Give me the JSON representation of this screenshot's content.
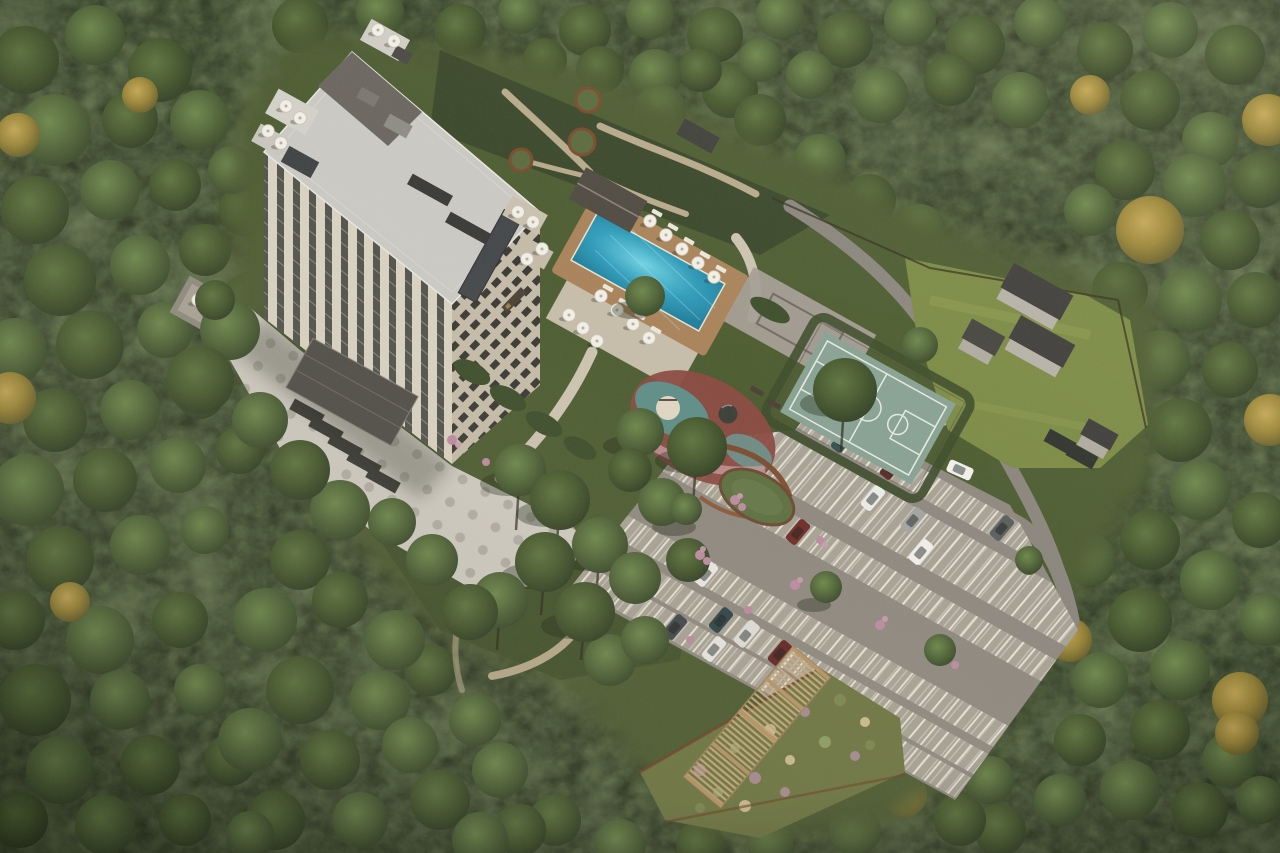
{
  "scene": {
    "type": "aerial-architectural-rendering",
    "subject": "forest resort hotel complex with pool, sports courts and parking",
    "colors": {
      "forest_base": "#2c3722",
      "forest_autumn": "#b99b49",
      "clearing": "#4d5c31",
      "lawn": "#7b8a45",
      "plaza": "#cdc9c0",
      "plaza_dot": "#a8a299",
      "path_tan": "#b7a98b",
      "walkway": "#cbc2b0",
      "road": "#8a857d",
      "pool_water": "#2f9cba",
      "pool_deck": "#a8825a",
      "pool_apron": "#cfc6b4",
      "poolhouse_roof": "#4f4a42",
      "facade_front": "#d8d1c0",
      "facade_side": "#c3baa8",
      "window_glass": "#3a3c38",
      "roof": "#c9c8c4",
      "roof_dark": "#6a6660",
      "entrance_canopy": "#504d48",
      "court": "#87a193",
      "court_line": "#e3e9e2",
      "practice_pavement": "#a39d95",
      "playground_red": "#8a4a42",
      "playground_teal": "#5f8d88",
      "pavilion_roof": "#5d7040",
      "corten": "#7a4a2c",
      "parking_asphalt": "#8e8880",
      "parking_band": "#a7a195",
      "stall_line": "#edeade",
      "pergola_wood": "#c8a97c",
      "flower_garden": "#6e7643",
      "shrub_dark": "#3d4d2b",
      "flower_pink": "#bb8aa0"
    },
    "building": {
      "floors_visible": 12,
      "rooftop_umbrella_count": 12,
      "has_brand_plaque": true
    },
    "pool": {
      "umbrella_count": 12,
      "lounger_count": 9
    },
    "parking": {
      "car_count": 14,
      "cars": [
        {
          "color": "#36504f"
        },
        {
          "color": "#5d2a26"
        },
        {
          "color": "#5b5e5f"
        },
        {
          "color": "#ebebe7"
        },
        {
          "color": "#a3a4a1"
        },
        {
          "color": "#efede8"
        },
        {
          "color": "#6e2d28"
        },
        {
          "color": "#e8e6e1"
        },
        {
          "color": "#dddcd6"
        },
        {
          "color": "#2f4549"
        },
        {
          "color": "#632726"
        },
        {
          "color": "#43474b"
        },
        {
          "color": "#e5e3de"
        },
        {
          "color": "#f0efeb"
        }
      ]
    },
    "site": {
      "utility_building_count": 4,
      "round_planter_count": 3,
      "pergola_module_count": 4
    },
    "amenities": [
      "outdoor-pool",
      "pool-house",
      "kids-playground",
      "basketball-court",
      "practice-court",
      "northeast-lawn",
      "pergola-garden",
      "parking-lot",
      "forecourt-plaza",
      "forest-trails"
    ]
  }
}
